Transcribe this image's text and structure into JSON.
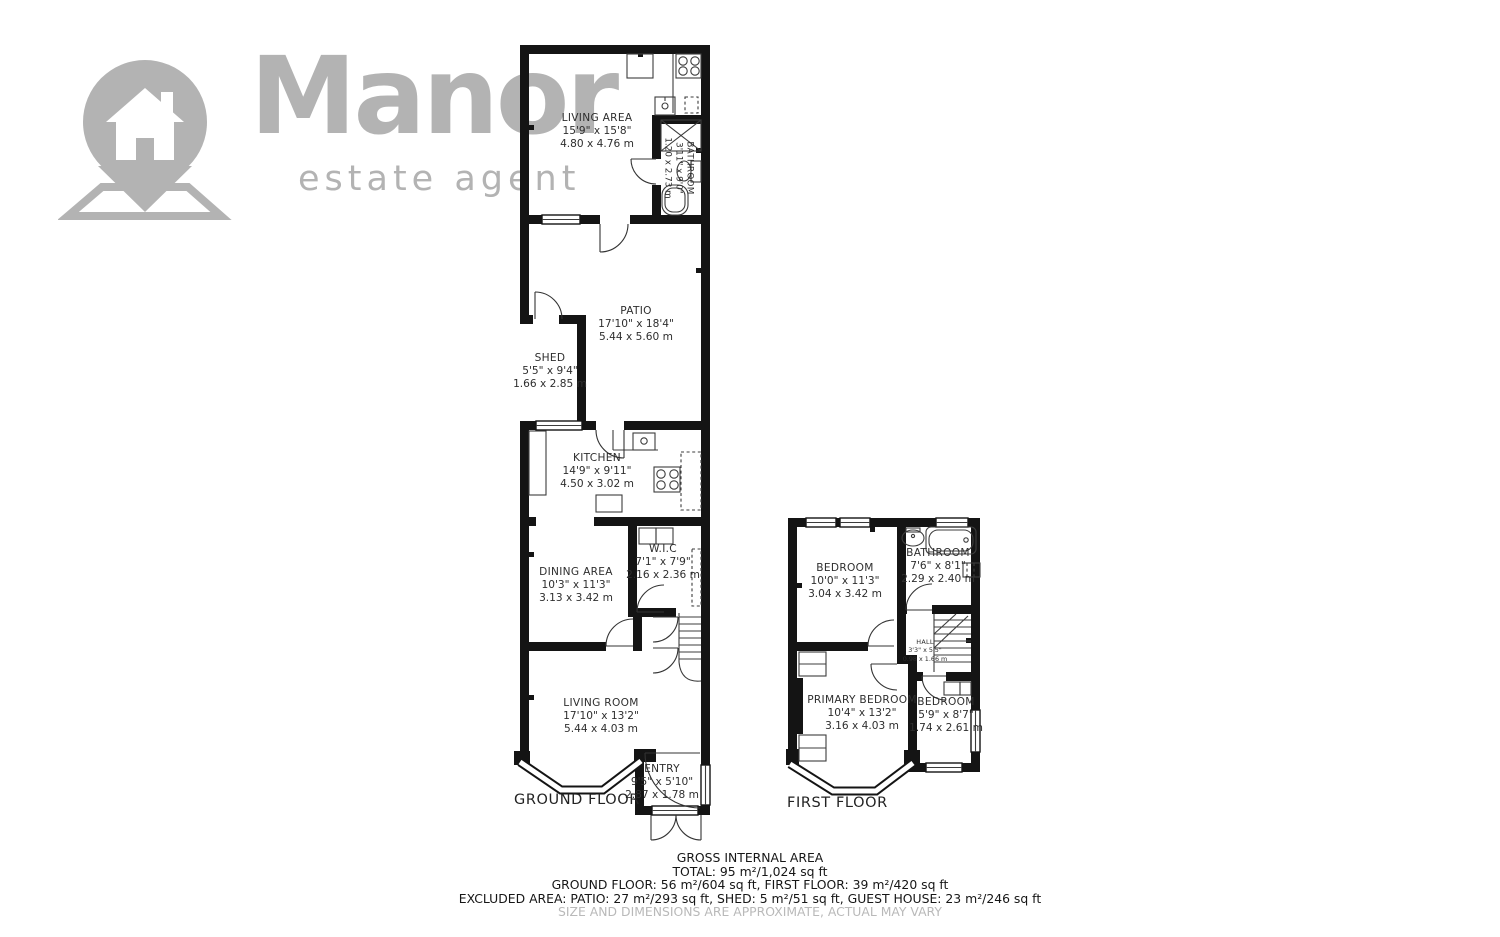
{
  "logo": {
    "name": "Manor",
    "tagline": "estate agent"
  },
  "colors": {
    "wall": "#141414",
    "logo": "#b3b3b3",
    "text": "#2e2e2e",
    "muted": "#b9b9b9"
  },
  "ground_floor": {
    "label": "GROUND FLOOR",
    "rooms": {
      "living_area": {
        "name": "LIVING AREA",
        "imperial": "15'9\" x 15'8\"",
        "metric": "4.80 x 4.76 m"
      },
      "gh_bathroom": {
        "name": "BATHROOM",
        "imperial": "3'11\" x 9'0\"",
        "metric": "1.20 x 2.73 m"
      },
      "patio": {
        "name": "PATIO",
        "imperial": "17'10\" x 18'4\"",
        "metric": "5.44 x 5.60 m"
      },
      "shed": {
        "name": "SHED",
        "imperial": "5'5\" x 9'4\"",
        "metric": "1.66 x 2.85 m"
      },
      "kitchen": {
        "name": "KITCHEN",
        "imperial": "14'9\" x 9'11\"",
        "metric": "4.50 x 3.02 m"
      },
      "dining_area": {
        "name": "DINING AREA",
        "imperial": "10'3\" x 11'3\"",
        "metric": "3.13 x 3.42 m"
      },
      "wic": {
        "name": "W.I.C",
        "imperial": "7'1\" x 7'9\"",
        "metric": "2.16 x 2.36 m"
      },
      "living_room": {
        "name": "LIVING ROOM",
        "imperial": "17'10\" x 13'2\"",
        "metric": "5.44 x 4.03 m"
      },
      "entry": {
        "name": "ENTRY",
        "imperial": "9'5\" x 5'10\"",
        "metric": "2.87 x 1.78 m"
      }
    }
  },
  "first_floor": {
    "label": "FIRST FLOOR",
    "rooms": {
      "bedroom": {
        "name": "BEDROOM",
        "imperial": "10'0\" x 11'3\"",
        "metric": "3.04 x 3.42 m"
      },
      "bathroom": {
        "name": "BATHROOM",
        "imperial": "7'6\" x 8'1\"",
        "metric": "2.29 x 2.40 m"
      },
      "hall": {
        "name": "HALL",
        "imperial": "3'3\" x 5'5\"",
        "metric": "0.98 x 1.66 m"
      },
      "primary_bedroom": {
        "name": "PRIMARY BEDROOM",
        "imperial": "10'4\" x 13'2\"",
        "metric": "3.16 x 4.03 m"
      },
      "small_bedroom": {
        "name": "BEDROOM",
        "imperial": "5'9\" x 8'7\"",
        "metric": "1.74 x 2.61 m"
      }
    }
  },
  "summary": {
    "line1": "GROSS INTERNAL AREA",
    "line2": "TOTAL: 95 m²/1,024 sq ft",
    "line3": "GROUND FLOOR: 56 m²/604 sq ft, FIRST FLOOR: 39 m²/420 sq ft",
    "line4": "EXCLUDED AREA: PATIO: 27 m²/293 sq ft, SHED: 5 m²/51 sq ft, GUEST HOUSE: 23 m²/246 sq ft",
    "disclaimer": "SIZE AND DIMENSIONS ARE APPROXIMATE, ACTUAL MAY VARY"
  }
}
